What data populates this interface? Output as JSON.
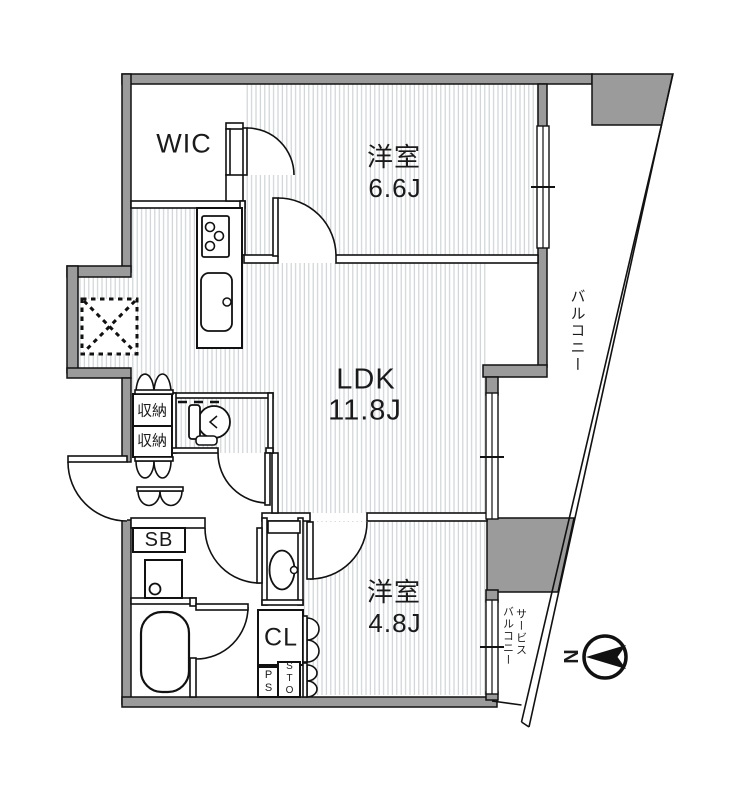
{
  "plan": {
    "rooms": {
      "wic": {
        "label": "WIC"
      },
      "bedroom_1": {
        "type": "洋室",
        "size": "6.6J"
      },
      "ldk": {
        "type": "LDK",
        "size": "11.8J"
      },
      "bedroom_2": {
        "type": "洋室",
        "size": "4.8J"
      }
    },
    "storage": {
      "closet_upper": "収納",
      "closet_lower": "収納",
      "shoe_box": "SB",
      "closet": "CL",
      "pipe_space": "PS",
      "storage_compartment": "STO"
    },
    "balcony": {
      "main": "バルコニー",
      "service_word_1": "サービス",
      "service_word_2": "バルコニー"
    },
    "compass": {
      "north": "N"
    },
    "fixtures": [
      "stove-icon",
      "kitchen-sink-icon",
      "toilet-icon",
      "washbasin-icon",
      "washing-machine-icon",
      "bathtub-icon",
      "refrigerator-space-icon",
      "compass-icon"
    ],
    "colors": {
      "wall_fill": "#9b9b9b",
      "line": "#111111",
      "hatch": "#cbd0d4"
    }
  }
}
